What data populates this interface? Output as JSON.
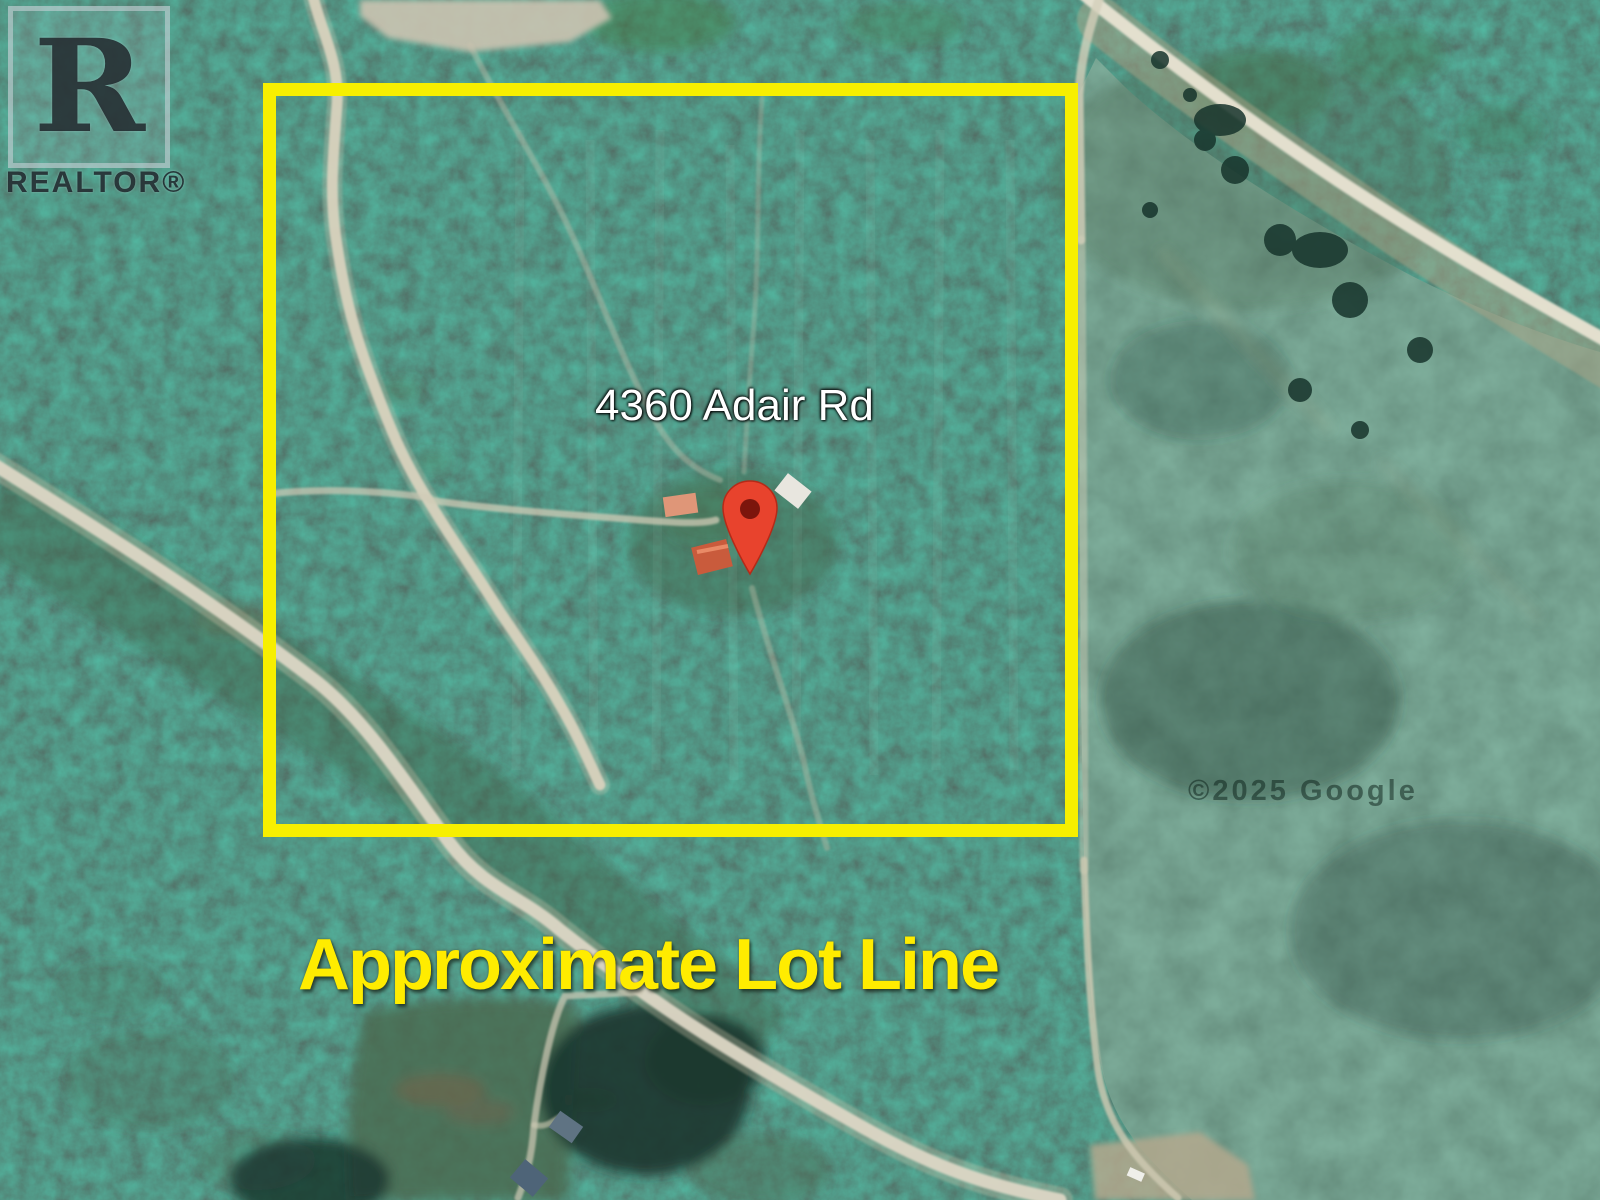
{
  "image": {
    "type": "aerial-satellite-listing-photo",
    "branding": {
      "logo_letter": "R",
      "logo_text": "REALTOR®"
    },
    "labels": {
      "address": "4360 Adair Rd",
      "lot_line": "Approximate Lot Line"
    },
    "attribution": "©2025 Google",
    "icons": [
      "location-pin-icon",
      "realtor-logo"
    ],
    "colors": {
      "lot_line_yellow": "#F7EF00",
      "lot_text_yellow": "#FFEC00",
      "pin_red": "#E8432D",
      "pin_inner_red": "#7C150C",
      "address_text": "#FFFFFF",
      "forest_green": "#1C3A32",
      "field_green": "#2B5C46",
      "road_tan": "#DCD6C4"
    }
  }
}
